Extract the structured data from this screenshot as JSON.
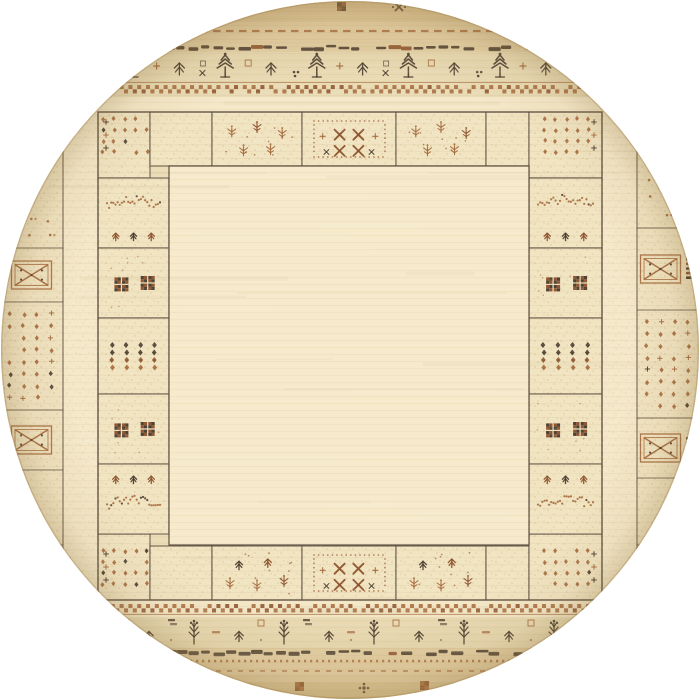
{
  "meta": {
    "domain": "Natural-Image",
    "alt": "Top-down product photo of a round hand-knotted Gabbeh-style wool rug in cream and beige. A plain cream square field is framed by a panel border of rectangular blocks filled with small tribal motifs - dot grids, seedling plants, X crosses, checkered squares and diamond rows - woven in rust brown and charcoal. Curved outer bands at the top and bottom of the circle carry pine-tree and flowering-plant motifs between dashed, wavy and checkerboard stripes, and X-in-box medallion columns with diamond dot grids run along the left and right edges.",
    "background": "#ffffff"
  },
  "palette": {
    "base": "#eadcb6",
    "margin": "#e5d2a8",
    "margin_dark": "#ddc697",
    "cream": "#f4e8c8",
    "block": "#f1e4c1",
    "field": "#f6eacb",
    "line": "#56483a",
    "rust": "#a4683c",
    "rust_deep": "#8a4f2a",
    "dark": "#46392c",
    "speckle": "#bb8f5a",
    "rim": "#a08050"
  },
  "circle": {
    "cx": 350,
    "cy": 350,
    "r": 349
  },
  "field": {
    "x": 169,
    "y": 166,
    "w": 360,
    "h": 379
  },
  "panel": {
    "x": 98,
    "y": 112,
    "w": 504,
    "h": 488,
    "xs": [
      98,
      150,
      212,
      302,
      396,
      486,
      529,
      602
    ],
    "top_motifs": [
      "corner-dots",
      "speckle",
      "plants",
      "x-cluster",
      "plants",
      "speckle",
      "corner-dots"
    ],
    "bottom_motifs": [
      "corner-dots",
      "speckle",
      "plants-trees",
      "x-cluster",
      "plants-trees",
      "speckle",
      "corner-dots"
    ],
    "row_y": {
      "top": [
        112,
        166
      ],
      "bottom": [
        546,
        600
      ]
    },
    "corner_y": {
      "top": [
        112,
        178
      ],
      "bottom": [
        534,
        600
      ]
    },
    "side_ys": [
      178,
      248,
      318,
      394,
      464,
      534
    ],
    "side_motifs": [
      "branch-trees",
      "dark-checkers",
      "diamond-rows",
      "dark-checkers",
      "trees-branch"
    ]
  },
  "outer_columns": {
    "left": {
      "x0": 0,
      "x1": 63,
      "ys": [
        112,
        248,
        302,
        410,
        470,
        545,
        608
      ],
      "motifs": [
        "dots-sparse",
        "x-box",
        "diamond-grid",
        "x-box",
        "speckle",
        "x-box"
      ]
    },
    "right": {
      "x0": 637,
      "x1": 700,
      "ys": [
        112,
        228,
        310,
        418,
        478,
        545,
        608
      ],
      "motifs": [
        "dots-sparse",
        "x-box-ladder",
        "diamond-grid",
        "x-box-ladder",
        "speckle",
        "dots-sparse"
      ]
    }
  },
  "strips": [
    {
      "x": 63,
      "y": 97,
      "w": 35,
      "h": 515
    },
    {
      "x": 602,
      "y": 97,
      "w": 35,
      "h": 515
    }
  ],
  "zones": [
    {
      "y": 0,
      "h": 52,
      "fill": "margin",
      "op": 1
    },
    {
      "y": 0,
      "h": 22,
      "fill": "margin_dark",
      "op": 0.6
    },
    {
      "y": 97,
      "h": 15,
      "fill": "cream",
      "op": 1
    },
    {
      "y": 600,
      "h": 17,
      "fill": "cream",
      "op": 1
    },
    {
      "y": 648,
      "h": 52,
      "fill": "margin",
      "op": 1
    },
    {
      "y": 682,
      "h": 18,
      "fill": "margin_dark",
      "op": 0.55
    }
  ],
  "bands": {
    "top": [
      {
        "type": "dashed-line",
        "y": 31
      },
      {
        "type": "wavy-line",
        "y": 46
      },
      {
        "type": "tree-row",
        "y": 64
      },
      {
        "type": "checker-band",
        "y": 85,
        "line": "above"
      }
    ],
    "bottom": [
      {
        "type": "checker-band",
        "y": 604,
        "line": "below"
      },
      {
        "type": "plant-row",
        "y": 633
      },
      {
        "type": "wavy-line",
        "y": 651
      },
      {
        "type": "dotted-line",
        "y": 661
      },
      {
        "type": "dashed-line-light",
        "y": 671
      }
    ]
  },
  "edge_motifs": {
    "top": [
      {
        "type": "check-square",
        "x": 337,
        "y": 2,
        "c": "dark"
      },
      {
        "type": "cross-dots",
        "x": 399,
        "y": 7
      },
      {
        "type": "rust-dash",
        "x": 448,
        "y": 8
      }
    ],
    "bottom": [
      {
        "type": "check-square",
        "x": 295,
        "y": 682,
        "c": "rust"
      },
      {
        "type": "dot-flower",
        "x": 364,
        "y": 688
      },
      {
        "type": "check-square",
        "x": 420,
        "y": 681,
        "c": "rust"
      }
    ]
  }
}
